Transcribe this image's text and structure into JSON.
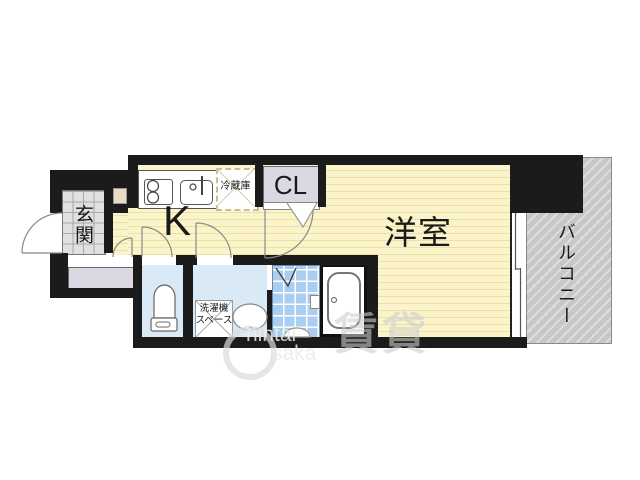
{
  "floorplan": {
    "rooms": {
      "entrance_label": "玄関",
      "kitchen_label": "K",
      "closet_label": "CL",
      "western_room_label": "洋室",
      "balcony_label": "バルコニー"
    },
    "annotations": {
      "refrigerator_label": "冷蔵庫",
      "washer_space_line1": "洗濯機",
      "washer_space_line2": "スペース"
    },
    "watermark": {
      "latin_line1": "hintai",
      "latin_line2": "saka",
      "kanji": "賃貸"
    },
    "colors": {
      "wall": "#1b1b1b",
      "room_yellow": "#fbf4cb",
      "room_yellow_stripe": "#ece0a6",
      "entrance_tile_gray": "#e0e0e0",
      "sanitary_blue": "#d9e9f5",
      "bath_tile_blue": "#a9cef1",
      "balcony_gray": "#c7c7c7",
      "closet_gray": "#dbd8e3",
      "meter_box_beige": "#e7dbc6"
    }
  }
}
